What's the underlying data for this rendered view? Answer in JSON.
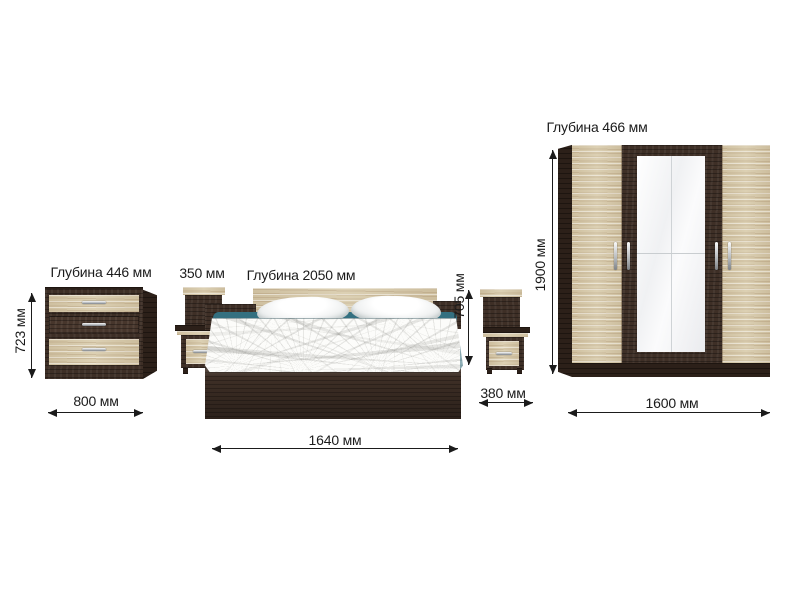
{
  "colors": {
    "background": "#ffffff",
    "light_wood": "#d8cbab",
    "dark_wood": "#3e2f26",
    "darker_wood": "#2c2019",
    "accent_teal": "#347080",
    "dimension_line": "#1b1b1b",
    "handle_silver": "#b9bdc0",
    "mirror": "#eaebee"
  },
  "furniture": {
    "dresser": {
      "depth_label": "Глубина 446 мм",
      "height_label": "723 мм",
      "width_label": "800 мм"
    },
    "nightstand_left": {
      "width_label": "350 мм"
    },
    "bed": {
      "depth_label": "Глубина 2050 мм",
      "height_label": "705 мм",
      "width_label": "1640 мм"
    },
    "nightstand_right": {
      "width_label": "380 мм"
    },
    "wardrobe": {
      "depth_label": "Глубина 466 мм",
      "height_label": "1900 мм",
      "width_label": "1600 мм"
    }
  }
}
